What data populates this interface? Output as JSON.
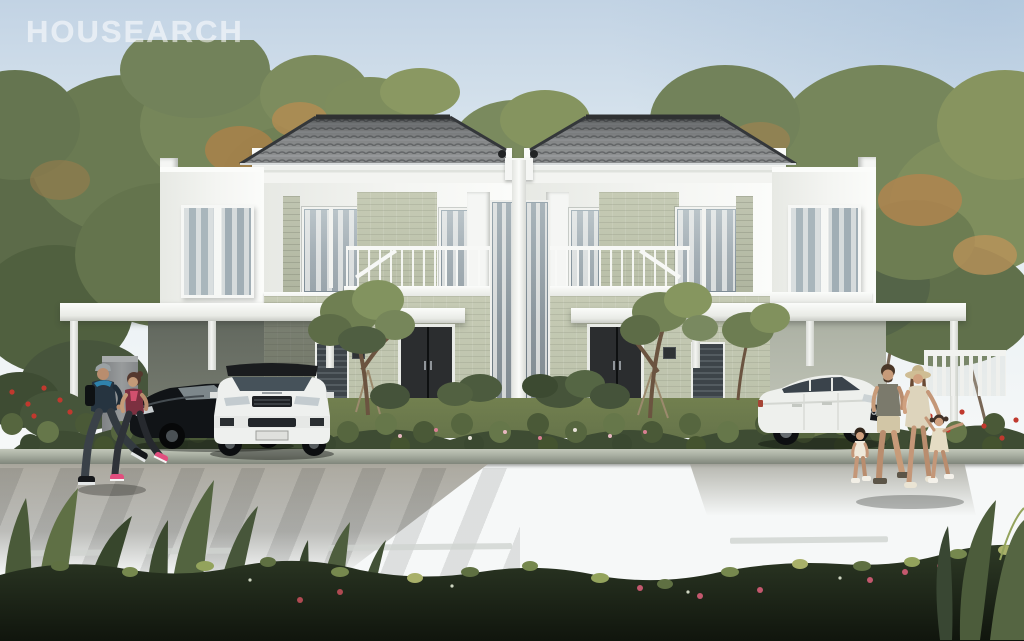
{
  "watermark": {
    "text": "HOUSEARCH"
  },
  "scene": {
    "title": "Twin two-storey house exterior rendering",
    "setting": "Daytime street view of a symmetrical white duplex with sage stone accents surrounded by large leafy trees",
    "house": {
      "units": 2,
      "storeys": 2,
      "features": [
        "grey tiled hip roof on each unit",
        "white fascia, fins and parapets",
        "sage stone feature walls",
        "tall curtained windows and bay windows",
        "white balcony railings with stair rail",
        "black double entry doors with number plaques",
        "shared central white column with double-height glazing",
        "flat-roofed carports on both outer wings",
        "young staked trees and flowering shrubs in the front garden"
      ]
    },
    "vehicles": [
      {
        "name": "black-sedan",
        "description": "Black sedan parked under the left carport"
      },
      {
        "name": "white-compact-suv",
        "description": "White compact SUV with black roof and dark grille in the left carport"
      },
      {
        "name": "white-audi-suv",
        "description": "White Audi SUV parked under the right carport"
      }
    ],
    "people": [
      {
        "name": "jogger-man",
        "description": "Man jogging left in dark blue hooded jacket, grey cap and black backpack"
      },
      {
        "name": "jogger-woman",
        "description": "Woman jogging left in maroon and pink top, dark leggings and pink shoes"
      },
      {
        "name": "father",
        "description": "Man in grey-green t-shirt and beige shorts walking right"
      },
      {
        "name": "mother",
        "description": "Woman in straw sun hat and beige dress"
      },
      {
        "name": "daughter-small",
        "description": "Small girl in cream outfit between the parents"
      },
      {
        "name": "daughter-right",
        "description": "Girl in beige dress holding her mother's hand, arm outstretched"
      }
    ],
    "street": {
      "road": "dark brick-paved road",
      "markings": "white dashed centre line",
      "sidewalk": "light paver driveway apron",
      "foreground": "dense dark hedge with tropical leaves along the bottom edge",
      "flowers": "red and pink flowering shrubs at both street corners"
    }
  },
  "colors": {
    "sky_top": "#c2d3e4",
    "sky_mid": "#e9f0f4",
    "sky_low": "#f6f8f8",
    "trim_white": "#f5f6f4",
    "wall_sage": "#c6cbb5",
    "roof_tile": "#7d8081",
    "roof_ridge": "#2f3132",
    "door_dark": "#2b2d2f",
    "foliage_dark": "#4c5a40",
    "foliage_mid": "#68794f",
    "foliage_light": "#8da06c",
    "foliage_autumn": "#b5854d",
    "lawn": "#66744a",
    "flower_red": "#c0392e",
    "flower_pink": "#d06a7e",
    "curb": "#a7ada0",
    "road_dark": "#424344",
    "marking": "#cfd3cf",
    "car_black": "#141619",
    "car_white": "#eff0ee",
    "skin": "#c49a78"
  }
}
